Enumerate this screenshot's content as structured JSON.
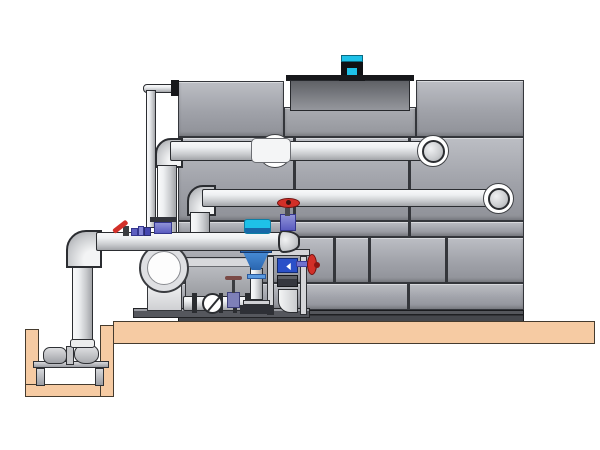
{
  "scene": {
    "type": "technical-illustration",
    "subject": "cooling-tower-with-pump-skid-and-sump",
    "colors": {
      "background": "#ffffff",
      "tower_panel_light": "#bcbec4",
      "tower_panel": "#a0a2a9",
      "tower_panel_dark": "#8f9198",
      "tower_seam": "#34363b",
      "tower_base_dark": "#3e4045",
      "fan_cowl_top": "#5f6166",
      "fan_cowl_bottom": "#95979d",
      "fan_rim": "#17181b",
      "motor_cyan": "#1ec1e8",
      "motor_dark": "#101114",
      "pipe_light": "#eef0f2",
      "pipe_mid": "#c9cbce",
      "pipe_shadow": "#a2a4a8",
      "pipe_outline": "#2b2d31",
      "slab_tan": "#f6cba3",
      "slab_outline": "#453b2e",
      "valve_red": "#d22f28",
      "valve_red_dark": "#701210",
      "valve_purple": "#7072ce",
      "valve_purple_dark": "#34368e",
      "feeder_blue": "#4a8fd9",
      "feeder_blue_dark": "#2a66b0",
      "actuator_cyan": "#1ec1e8",
      "display_blue": "#2b50c8",
      "metal_gray": "#9b9da3",
      "metal_dark": "#55575d",
      "frame_light": "#d4d5d8"
    },
    "components": [
      {
        "name": "cooling-tower",
        "description": "gray paneled cooling tower casing with seam lines"
      },
      {
        "name": "fan-cowl",
        "description": "recessed fan cylinder on tower roof"
      },
      {
        "name": "fan-motor",
        "description": "cyan fan motor on top of cowl"
      },
      {
        "name": "upper-pipe",
        "description": "upper horizontal supply pipe entering tower wall"
      },
      {
        "name": "lower-pipe",
        "description": "lower horizontal pipe entering tower wall"
      },
      {
        "name": "suction-header",
        "description": "front horizontal header pipe with domed end cap"
      },
      {
        "name": "thin-makeup-line",
        "description": "small-bore vertical line up tower left side"
      },
      {
        "name": "sump-riser",
        "description": "vertical pipe from header down into sump pit"
      },
      {
        "name": "sump-pit",
        "description": "below-grade tan pit with pump stand"
      },
      {
        "name": "sump-pump",
        "description": "horizontal pump and motor on stand inside pit"
      },
      {
        "name": "concrete-slab",
        "description": "tan equipment slab"
      },
      {
        "name": "centrifugal-pump",
        "description": "end-suction pump with large round inlet"
      },
      {
        "name": "pump-motor",
        "description": "gray motor box behind pump"
      },
      {
        "name": "check-valve",
        "description": "wafer check valve on skid base pipe"
      },
      {
        "name": "gate-valve-small",
        "description": "small gate valve with tee handle"
      },
      {
        "name": "chemical-feeder-cone",
        "description": "blue cone separator/feeder under header"
      },
      {
        "name": "instrument-stand",
        "description": "frame stand with blue meter display"
      },
      {
        "name": "red-handwheel-valve",
        "description": "red handwheel valve on header end"
      },
      {
        "name": "red-lever-valve",
        "description": "small red lever ball valve on header"
      },
      {
        "name": "side-handwheel-valve",
        "description": "red handwheel valve facing right off stand"
      },
      {
        "name": "butterfly-actuator",
        "description": "cyan butterfly valve actuator on header"
      },
      {
        "name": "pipe-coupling",
        "description": "white sleeve coupling on upper pipe"
      },
      {
        "name": "wall-escutcheon",
        "description": "white wall ring where pipes enter tower"
      }
    ]
  }
}
